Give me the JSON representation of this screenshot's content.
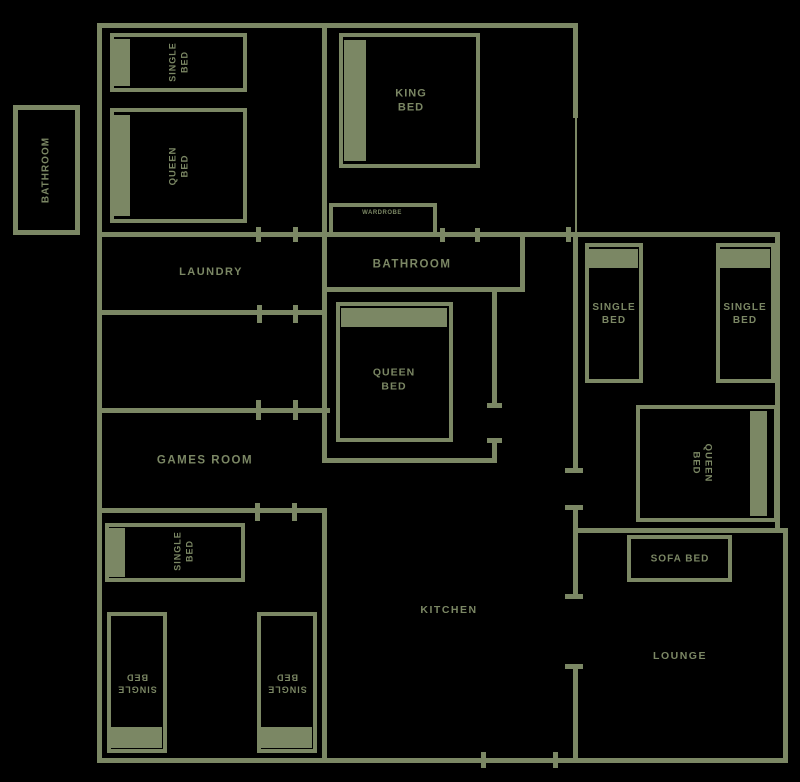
{
  "palette": {
    "line_color": "#7b8764",
    "background_color": "#000000"
  },
  "rooms": {
    "bathroom_outside": {
      "label": "BATHROOM"
    },
    "laundry": {
      "label": "LAUNDRY"
    },
    "bathroom_main": {
      "label": "BATHROOM"
    },
    "games_room": {
      "label": "GAMES ROOM"
    },
    "kitchen": {
      "label": "KITCHEN"
    },
    "lounge": {
      "label": "LOUNGE"
    }
  },
  "furniture": {
    "single_bed_nw": {
      "label": "SINGLE\nBED"
    },
    "queen_bed_nw": {
      "label": "QUEEN\nBED"
    },
    "king_bed": {
      "label": "KING\nBED"
    },
    "wardrobe": {
      "label": "WARDROBE"
    },
    "queen_bed_middle": {
      "label": "QUEEN\nBED"
    },
    "single_bed_east_1": {
      "label": "SINGLE\nBED"
    },
    "single_bed_east_2": {
      "label": "SINGLE\nBED"
    },
    "queen_bed_east": {
      "label": "QUEEN\nBED"
    },
    "sofa_bed": {
      "label": "SOFA BED"
    },
    "single_bed_sw": {
      "label": "SINGLE\nBED"
    },
    "single_bed_south_1": {
      "label": "SINGLE\nBED"
    },
    "single_bed_south_2": {
      "label": "SINGLE\nBED"
    }
  }
}
